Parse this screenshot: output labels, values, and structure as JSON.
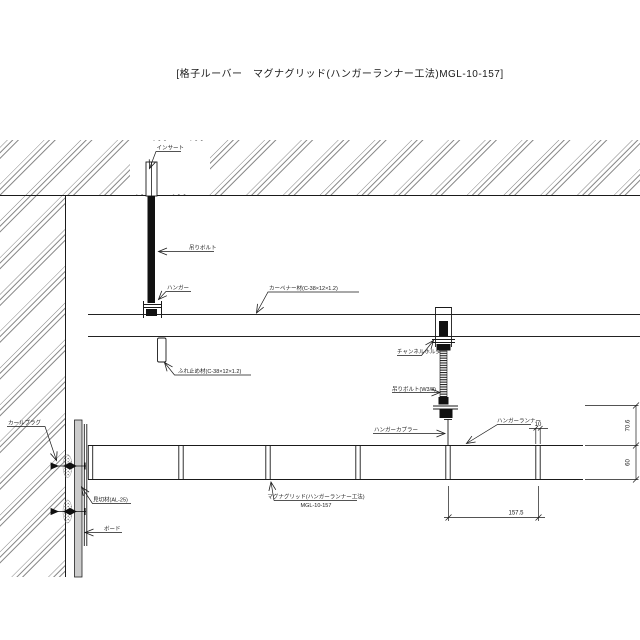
{
  "title": "[格子ルーバー　マグナグリッド(ハンガーランナー工法)MGL-10-157]",
  "labels": {
    "insert": "インサート",
    "hanging_bolt": "吊りボルト",
    "hanger": "ハンガー",
    "carpenter_channel": "カーペナー材(C-38×12×1.2)",
    "brace_channel": "ふれ止め材(C-38×12×1.2)",
    "channel_holder": "チャンネルホルダー",
    "hanging_bolt_w38": "吊りボルト(W3/8)",
    "hanger_coupler": "ハンガーカプラー",
    "hanger_runner": "ハンガーランナー",
    "curl_plug": "カールプラグ",
    "edge_trim": "見切材(AL-25)",
    "board": "ボード",
    "product_line1": "マグナグリッド(ハンガーランナー工法)",
    "product_line2": "MGL-10-157"
  },
  "dimensions": {
    "blade_thickness": "10",
    "upper_height": "70.6",
    "louver_height": "60",
    "blade_pitch": "157.5"
  },
  "colors": {
    "line": "#1a1a1a",
    "hatch": "#666666",
    "board_fill": "#cccccc"
  }
}
